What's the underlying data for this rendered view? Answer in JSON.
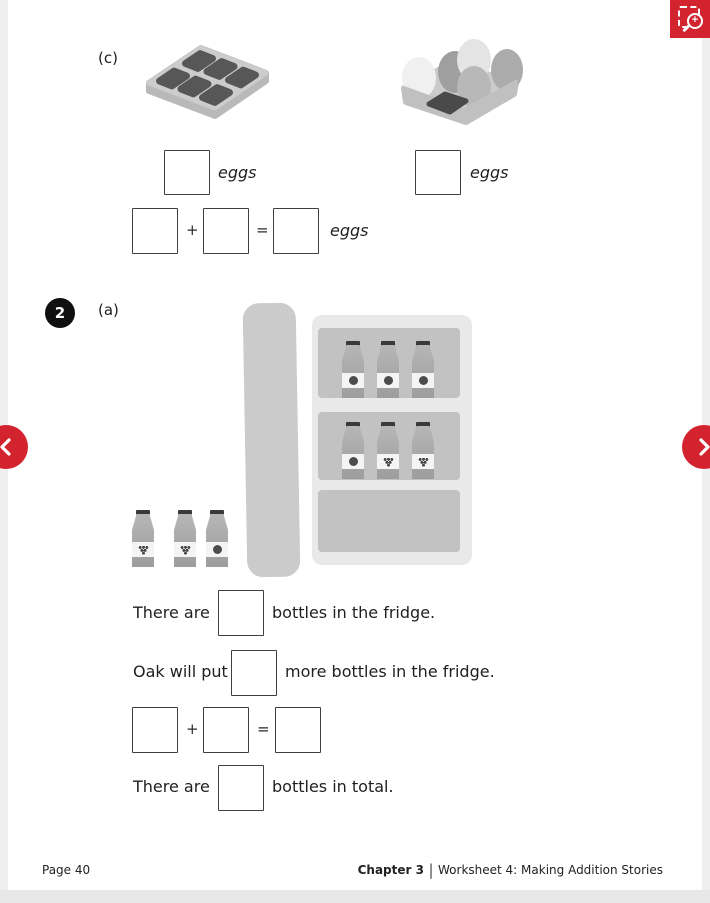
{
  "colors": {
    "accent_red": "#d2232f",
    "page_background": "#ffffff",
    "gutter": "#efefef",
    "ink": "#1f1f1f"
  },
  "viewer": {
    "zoom_button_icon": "zoom-region-icon",
    "prev_button_icon": "chevron-left-icon",
    "next_button_icon": "chevron-right-icon"
  },
  "worksheet": {
    "section_c": {
      "label": "(c)",
      "tray_caption": "eggs",
      "carton_caption": "eggs",
      "equation_plus": "+",
      "equation_equals": "=",
      "equation_suffix": "eggs"
    },
    "question2": {
      "number": "2",
      "part": "(a)",
      "line1": {
        "prefix": "There are",
        "suffix": "bottles in the fridge."
      },
      "line2": {
        "prefix": "Oak will put",
        "suffix": "more bottles in the fridge."
      },
      "equation_plus": "+",
      "equation_equals": "=",
      "line4": {
        "prefix": "There are",
        "suffix": "bottles in total."
      }
    },
    "illustrations": {
      "egg_tray": {
        "compartments": 6,
        "eggs": 0
      },
      "egg_carton": {
        "slots": 6,
        "eggs": 5,
        "empty_slots": 1
      },
      "fridge": {
        "top_shelf_bottles": 3,
        "middle_shelf_bottles": 3,
        "bottom_shelf_bottles": 0,
        "outside_bottles": 3
      }
    }
  },
  "footer": {
    "page": "Page 40",
    "chapter": "Chapter 3",
    "separator": "|",
    "worksheet_title": "Worksheet 4: Making Addition Stories"
  }
}
